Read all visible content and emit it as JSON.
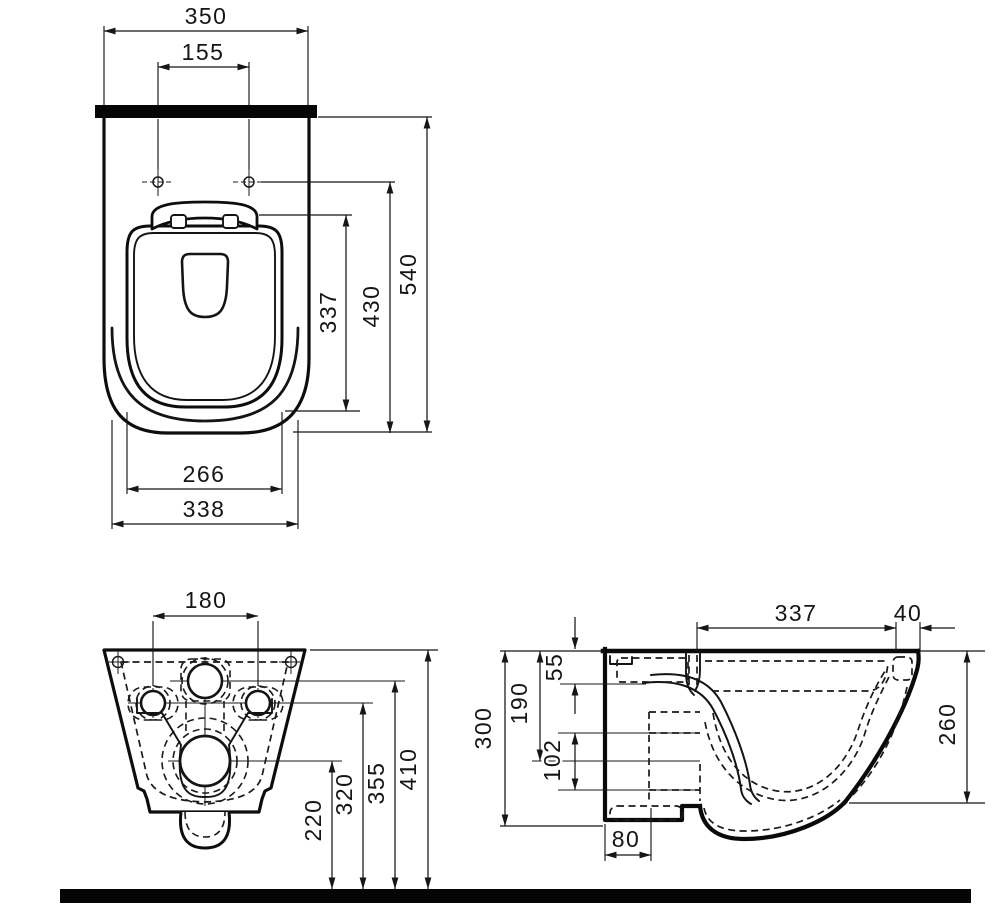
{
  "title": "Wall-hung WC ceramic pan technical dimension drawing (three orthographic views)",
  "colors": {
    "line": "#141414",
    "background": "#ffffff",
    "solid_bar": "#000000"
  },
  "top": {
    "width": "350",
    "hole_spacing": "155",
    "seat_depth": "337",
    "hole_depth": "430",
    "total_depth": "540",
    "seat_width": "266",
    "bowl_width": "338"
  },
  "back": {
    "hole_spacing": "180",
    "drain_height": "220",
    "side_hole_height": "320",
    "inlet_height": "355",
    "top_height": "410"
  },
  "side": {
    "depth": "337",
    "rim_depth": "40",
    "inlet_drop": "55",
    "drain_drop": "190",
    "height": "300",
    "port_span": "102",
    "front_height": "260",
    "drain_offset": "80"
  }
}
